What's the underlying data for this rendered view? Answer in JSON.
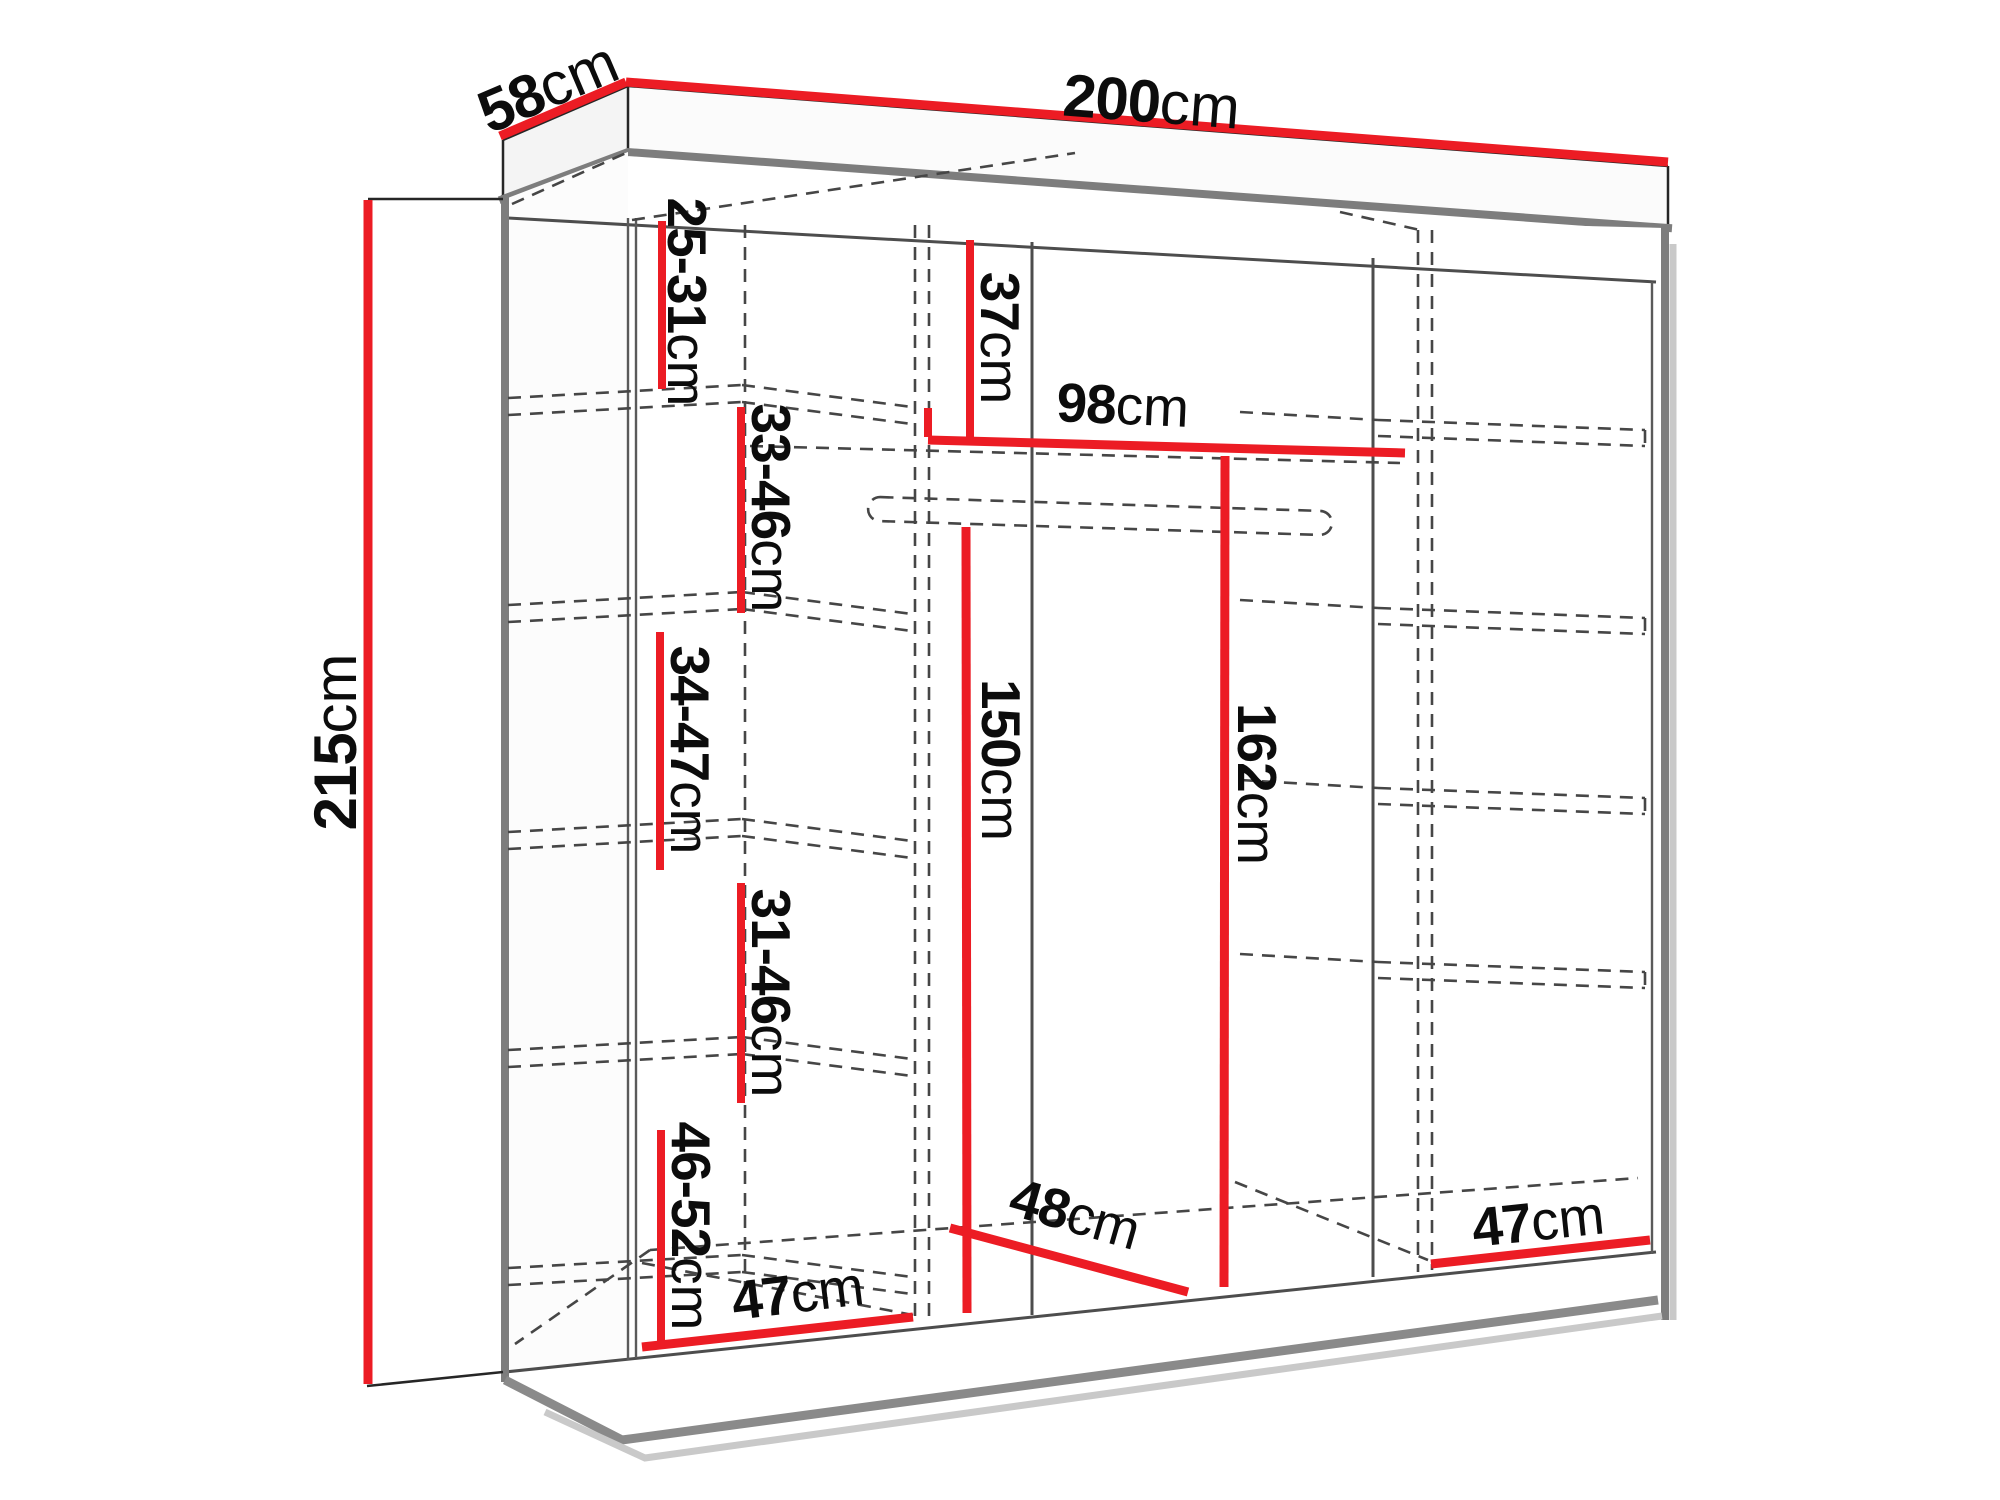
{
  "page": {
    "background": "#ffffff"
  },
  "colors": {
    "dimension_red": "#ec1c24",
    "outline_dark": "#262626",
    "edge_gray": "#7d7d7d",
    "hidden_dash_gray": "#464646",
    "label_black": "#0c0c0c"
  },
  "diagram": {
    "type": "furniture-dimension-drawing",
    "overall": {
      "width": {
        "value": "200",
        "unit": "cm"
      },
      "depth": {
        "value": "58",
        "unit": "cm"
      },
      "height": {
        "value": "215",
        "unit": "cm"
      }
    },
    "left_column_shelf_gaps": [
      {
        "value": "25-31",
        "unit": "cm"
      },
      {
        "value": "33-46",
        "unit": "cm"
      },
      {
        "value": "34-47",
        "unit": "cm"
      },
      {
        "value": "31-46",
        "unit": "cm"
      },
      {
        "value": "46-52",
        "unit": "cm"
      }
    ],
    "interior": {
      "top_shelf_gap": {
        "value": "37",
        "unit": "cm"
      },
      "middle_section_width": {
        "value": "98",
        "unit": "cm"
      },
      "hanging_height_left": {
        "value": "150",
        "unit": "cm"
      },
      "hanging_height_right": {
        "value": "162",
        "unit": "cm"
      },
      "interior_depth": {
        "value": "48",
        "unit": "cm"
      },
      "left_section_width": {
        "value": "47",
        "unit": "cm"
      },
      "right_section_width": {
        "value": "47",
        "unit": "cm"
      }
    }
  }
}
